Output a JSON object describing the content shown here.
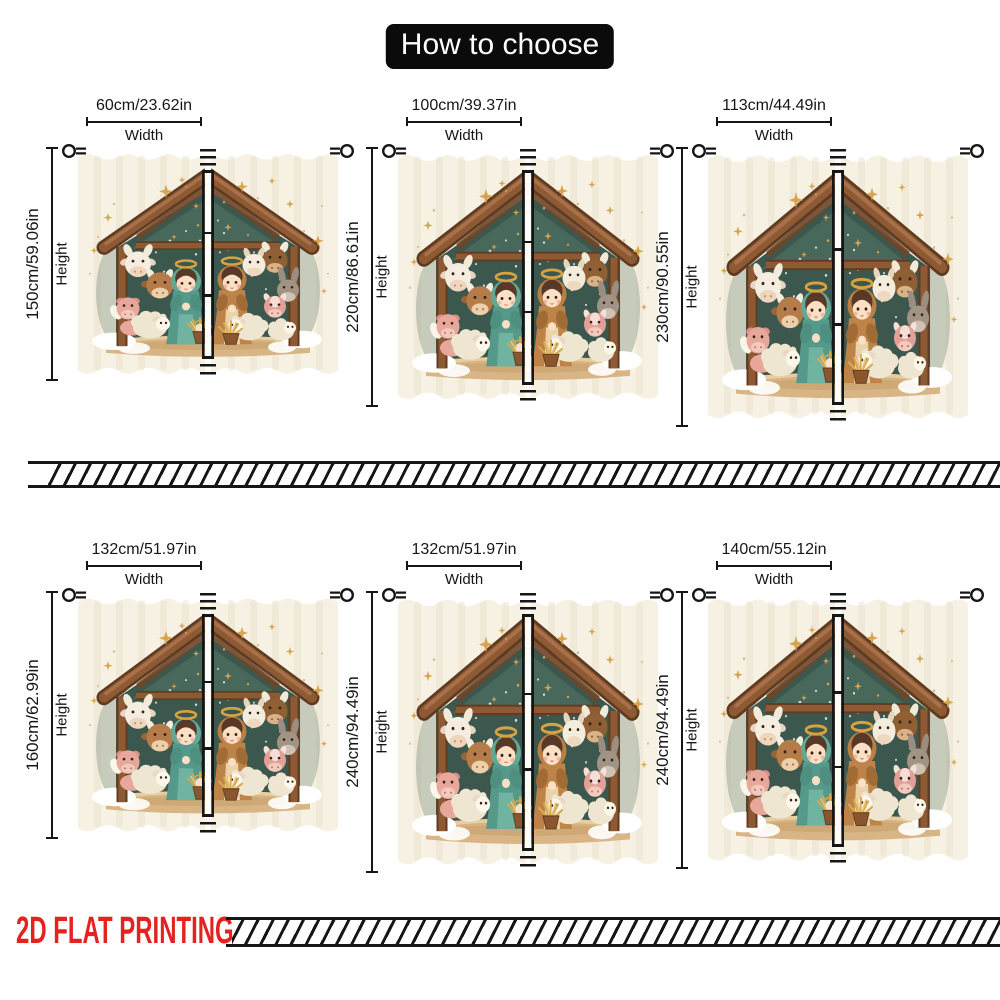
{
  "title": "How to choose",
  "labels": {
    "width": "Width",
    "height": "Height"
  },
  "panels": [
    {
      "name": "60x150",
      "width_label": "60cm/23.62in",
      "height_label": "150cm/59.06in"
    },
    {
      "name": "100x220",
      "width_label": "100cm/39.37in",
      "height_label": "220cm/86.61in"
    },
    {
      "name": "113x230",
      "width_label": "113cm/44.49in",
      "height_label": "230cm/90.55in"
    },
    {
      "name": "132x160",
      "width_label": "132cm/51.97in",
      "height_label": "160cm/62.99in"
    },
    {
      "name": "132x240",
      "width_label": "132cm/51.97in",
      "height_label": "240cm/94.49in"
    },
    {
      "name": "140x240",
      "width_label": "140cm/55.12in",
      "height_label": "240cm/94.49in"
    }
  ],
  "footer": {
    "printing_label": "2D FLAT PRINTING"
  },
  "colors": {
    "accent-red": "#e42320",
    "title-bg": "#0b0b0b",
    "title-text": "#ffffff",
    "line": "#161616"
  },
  "icons": {
    "ring": "curtain-ring-icon",
    "rod": "curtain-rod-icon",
    "divider": "hatched-rod-bar"
  }
}
